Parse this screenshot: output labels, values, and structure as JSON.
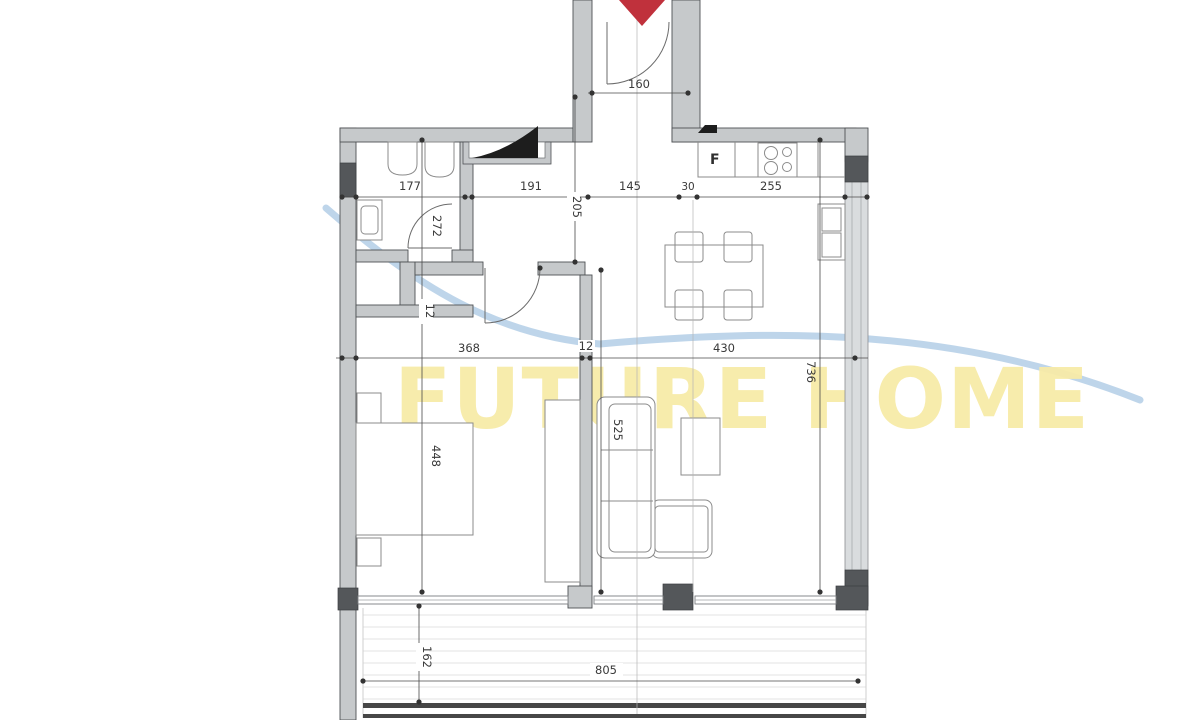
{
  "watermark": {
    "text": "FUTURE HOME"
  },
  "kitchen": {
    "fridge_label": "F"
  },
  "dims": {
    "entrance_door": "160",
    "bath_width": "177",
    "hall_width": "191",
    "hall_mid": "145",
    "shaft_width": "30",
    "kitchen_width": "255",
    "hall_depth": "205",
    "bath_height": "272",
    "wall_left": "12",
    "bedroom_width": "368",
    "wall_mid": "12",
    "living_width": "430",
    "right_height": "736",
    "bedroom_height": "448",
    "living_height": "525",
    "terrace_depth": "162",
    "terrace_width": "805"
  },
  "colors": {
    "wall_fill": "#c6c9cb",
    "wall_stroke": "#4e5154",
    "dark_column": "#54575a",
    "dimension_line": "#3a3a3a",
    "entrance_arrow": "#c0313c",
    "watermark_yellow": "#f7eba8",
    "watermark_blue": "#aecbe5",
    "furniture_stroke": "#8b8b8b"
  }
}
